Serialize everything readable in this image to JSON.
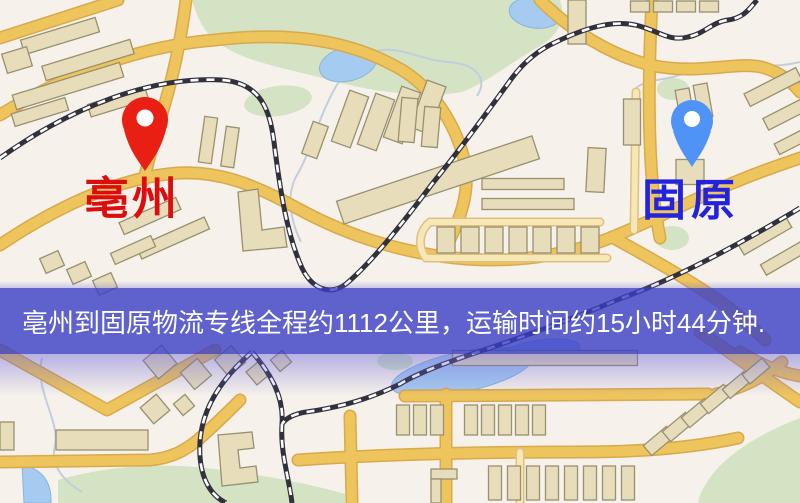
{
  "map": {
    "origin": {
      "label": "亳州"
    },
    "destination": {
      "label": "固原"
    },
    "banner": {
      "text": "亳州到固原物流专线全程约1112公里，运输时间约15小时44分钟."
    }
  },
  "icons": {
    "origin_pin": "location-pin-icon",
    "destination_pin": "location-pin-icon"
  },
  "colors": {
    "origin_label": "#de0d0d",
    "origin_pin": "#ea1f14",
    "destination_label": "#2323dc",
    "destination_pin": "#4f93f7",
    "banner_background": "#3a3fc6",
    "banner_text": "#ffffff",
    "map_background": "#f6f1ea",
    "road": "#eec45d",
    "park": "#d3e3c3",
    "water": "#a6cbf0",
    "building": "#e7ddbb",
    "railway": "#31313d"
  }
}
